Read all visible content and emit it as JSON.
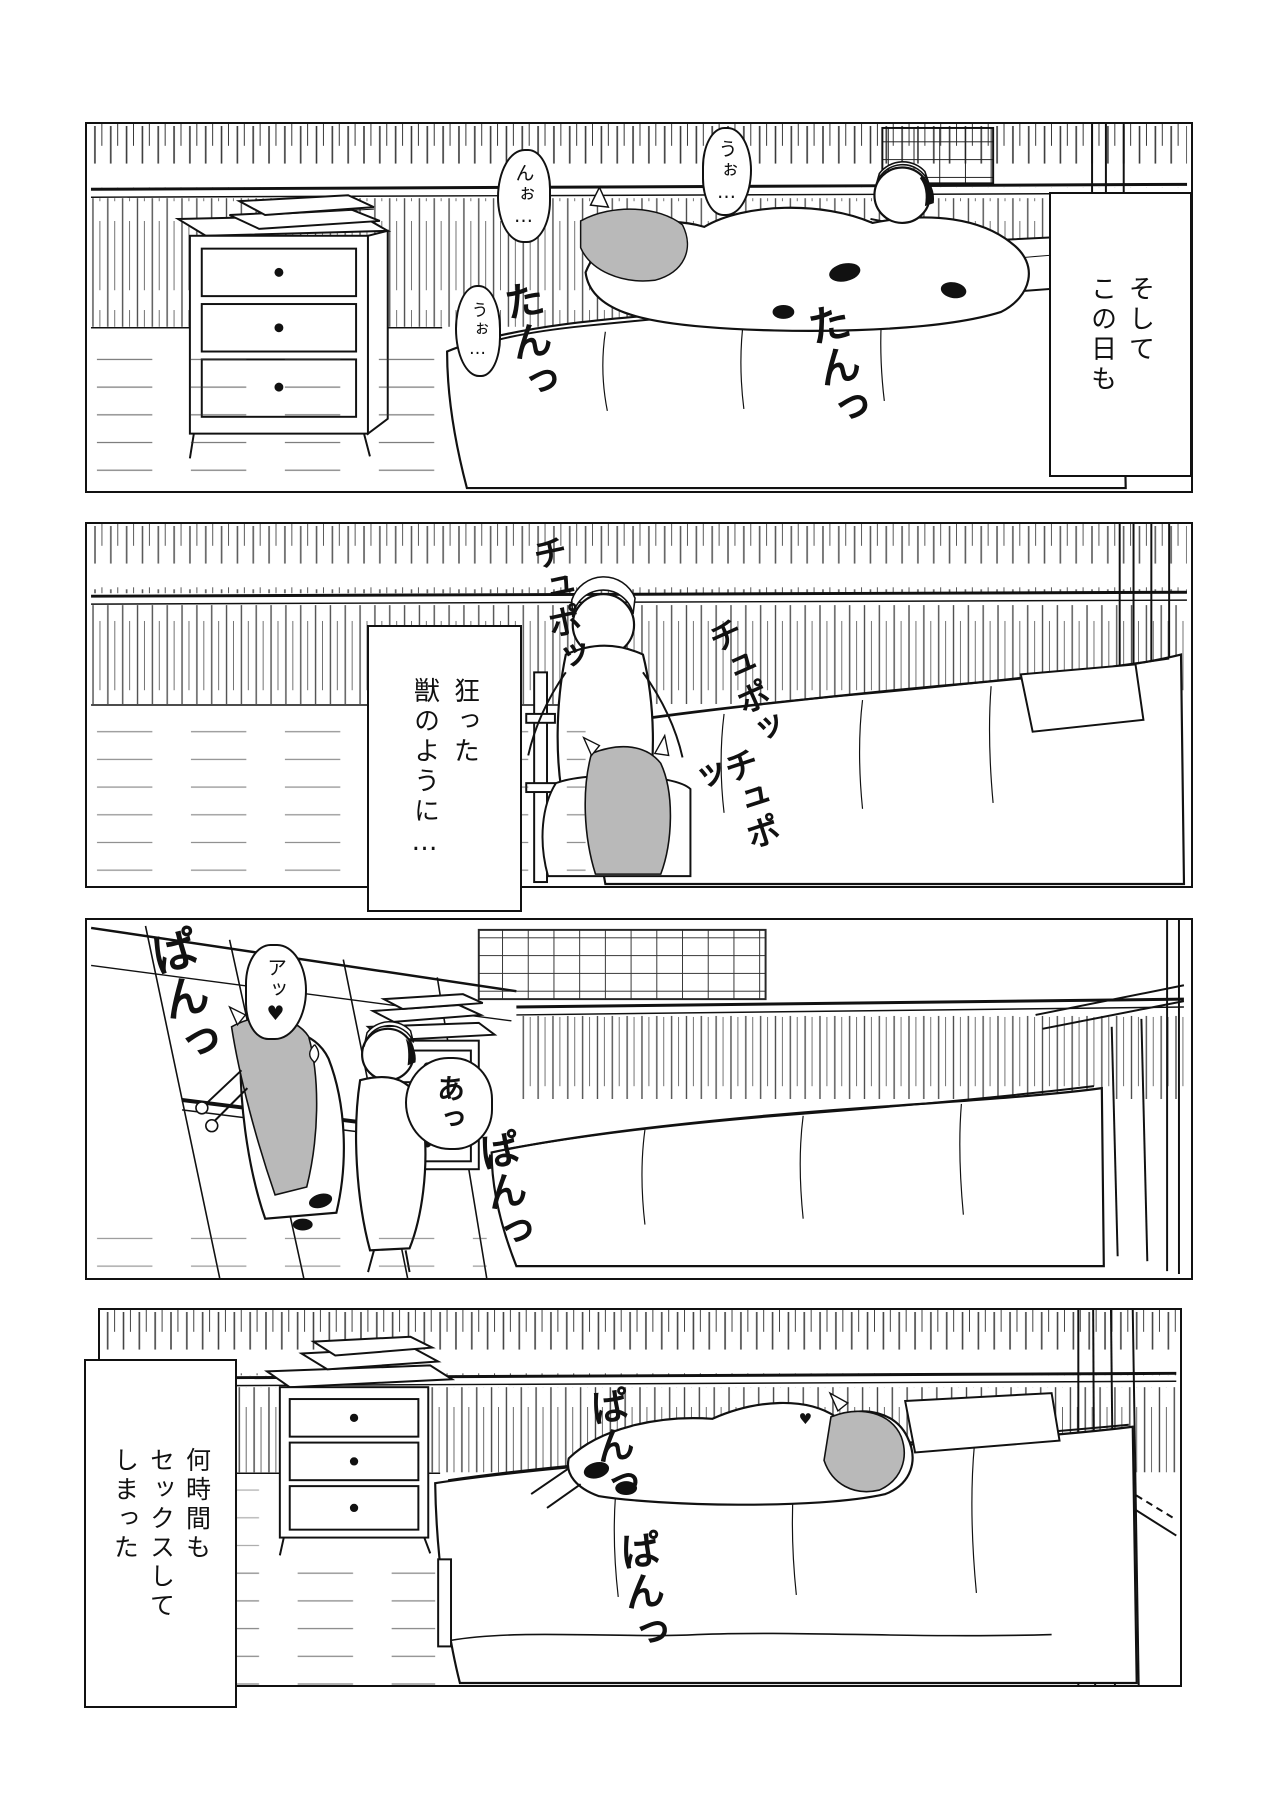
{
  "page": {
    "kind_label": "manga-page",
    "ink": "#111111",
    "paper": "#ffffff",
    "hair_gray": "#b9b9b9"
  },
  "panels": [
    {
      "name": "panel-1",
      "caption": {
        "lines": [
          "そして",
          "この日も"
        ]
      },
      "bubbles": [
        {
          "text": "うぉ…"
        },
        {
          "text": "んぉ…"
        },
        {
          "text": "うぉ…"
        }
      ],
      "sfx": [
        {
          "text": "たんっ"
        },
        {
          "text": "たんっ"
        }
      ]
    },
    {
      "name": "panel-2",
      "caption": {
        "lines": [
          "狂った",
          "獣のように…"
        ]
      },
      "bubbles": [],
      "sfx": [
        {
          "text": "チュポッ"
        },
        {
          "text": "チュポッ"
        },
        {
          "text": "チュポッ"
        }
      ]
    },
    {
      "name": "panel-3",
      "caption": null,
      "bubbles": [
        {
          "text": "アッ♥"
        },
        {
          "text": "あっ"
        }
      ],
      "sfx": [
        {
          "text": "ぱんっ"
        },
        {
          "text": "ぱんっ"
        }
      ]
    },
    {
      "name": "panel-4",
      "caption": {
        "lines": [
          "何時間も",
          "セックスして",
          "しまった"
        ]
      },
      "bubbles": [],
      "sfx": [
        {
          "text": "ぱんっ"
        },
        {
          "text": "ぱんっ"
        },
        {
          "text": "♥"
        }
      ]
    }
  ]
}
